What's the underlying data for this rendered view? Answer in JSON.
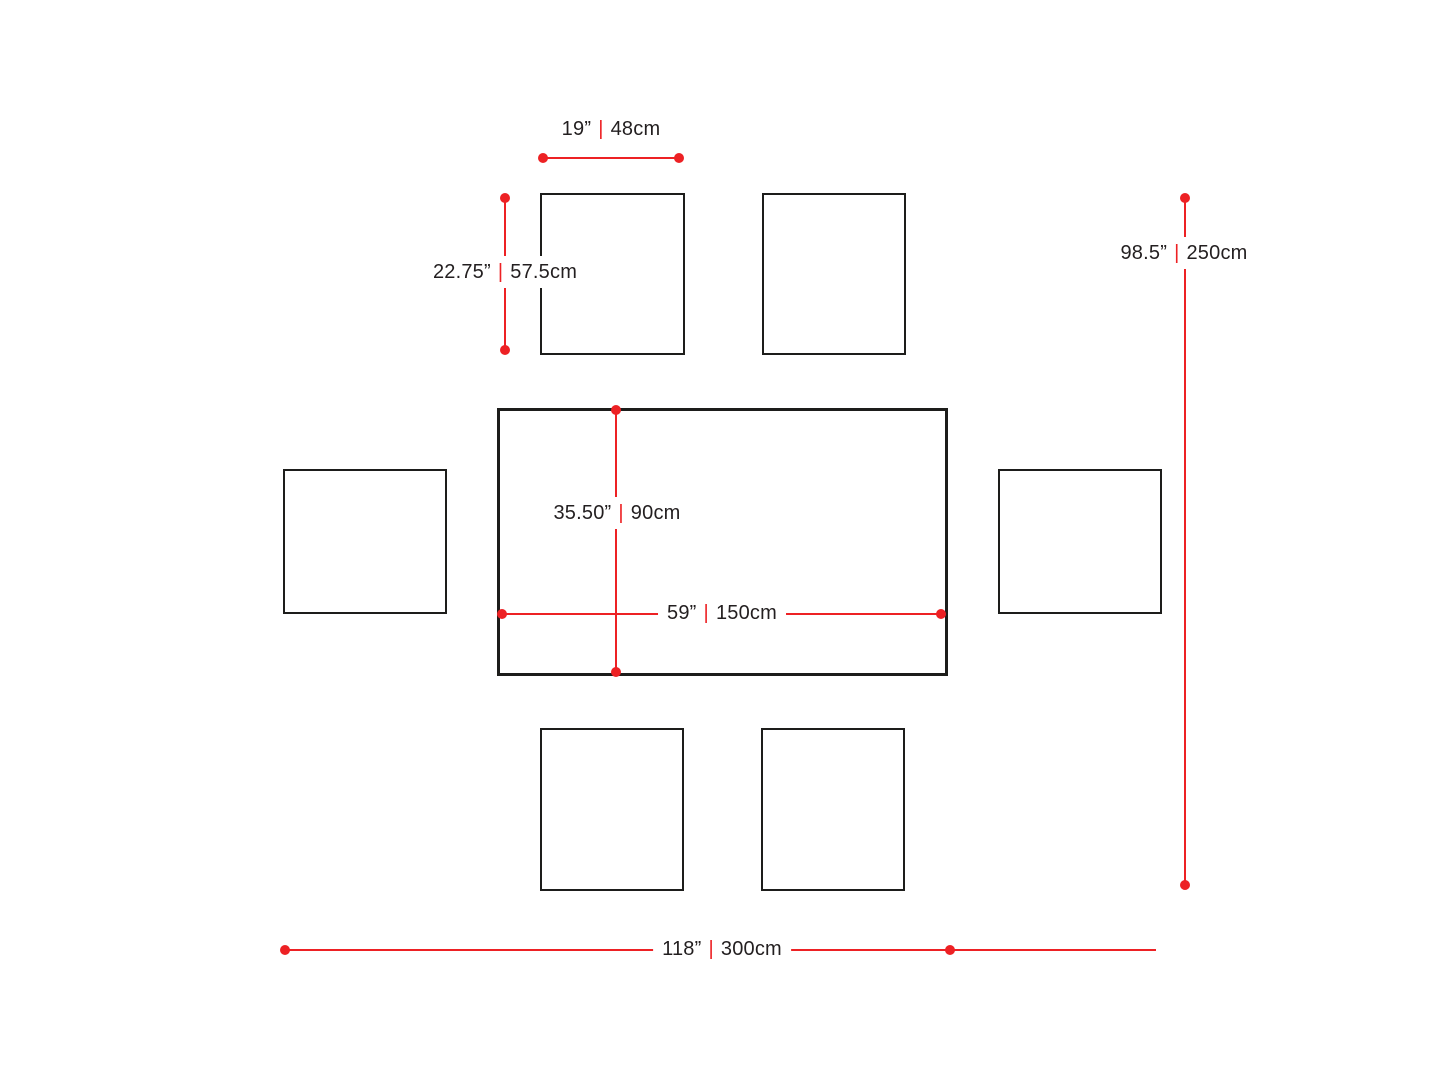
{
  "diagram": {
    "type": "furniture-dimensions-top-view",
    "background": "#ffffff",
    "accent_color": "#ed2124",
    "text_color": "#231f20",
    "outline_color": "#1d1d1b",
    "furniture": {
      "table_count": 1,
      "chair_count": 6
    }
  },
  "labels": {
    "chair_width": {
      "imperial": "19”",
      "separator": "|",
      "metric": "48cm"
    },
    "chair_depth": {
      "imperial": "22.75”",
      "separator": "|",
      "metric": "57.5cm"
    },
    "table_depth": {
      "imperial": "35.50”",
      "separator": "|",
      "metric": "90cm"
    },
    "table_width": {
      "imperial": "59”",
      "separator": "|",
      "metric": "150cm"
    },
    "overall_depth": {
      "imperial": "98.5”",
      "separator": "|",
      "metric": "250cm"
    },
    "overall_width": {
      "imperial": "118”",
      "separator": "|",
      "metric": "300cm"
    }
  }
}
